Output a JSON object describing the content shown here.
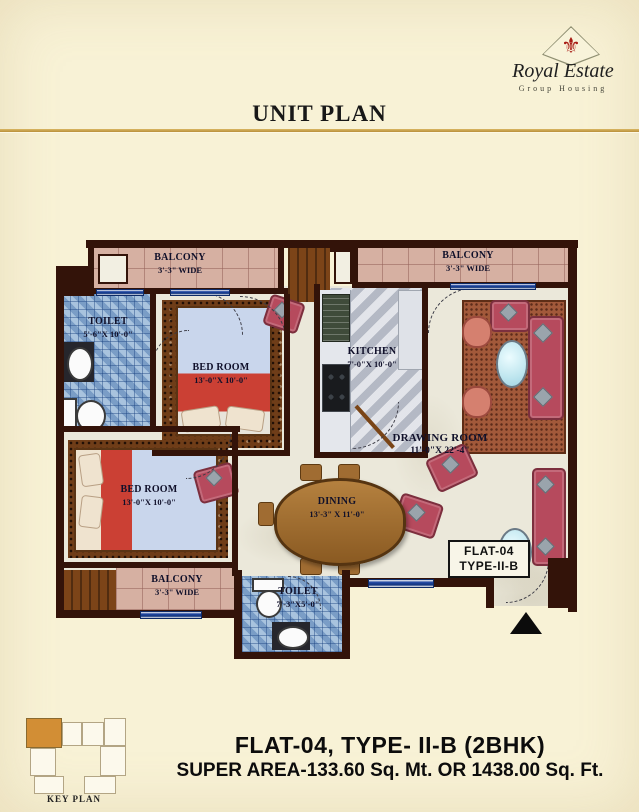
{
  "header": {
    "brand": {
      "name": "Royal Estate",
      "tagline": "Group Housing"
    },
    "title": "UNIT PLAN"
  },
  "plan": {
    "rooms": {
      "balcony_top_left": {
        "name": "BALCONY",
        "size": "3'-3\" WIDE"
      },
      "balcony_top_right": {
        "name": "BALCONY",
        "size": "3'-3\" WIDE"
      },
      "balcony_bottom": {
        "name": "BALCONY",
        "size": "3'-3\" WIDE"
      },
      "toilet_top": {
        "name": "TOILET",
        "size": "5'-6\"X 10'-0\""
      },
      "bedroom_top": {
        "name": "BED ROOM",
        "size": "13'-0\"X 10'-0\""
      },
      "bedroom_left": {
        "name": "BED ROOM",
        "size": "13'-0\"X 10'-0\""
      },
      "kitchen": {
        "name": "KITCHEN",
        "size": "7'-0\"X 10'-0\""
      },
      "drawing_room": {
        "name": "DRAWING ROOM",
        "size": "11'-0\"X 22'-4\""
      },
      "dining": {
        "name": "DINING",
        "size": "13'-3\" X 11'-0\""
      },
      "toilet_bottom": {
        "name": "TOILET",
        "size": "7'-3\"X5'-0\""
      }
    },
    "flat_tag": {
      "line1": "FLAT-04",
      "line2": "TYPE-II-B"
    }
  },
  "key_plan": {
    "label": "KEY PLAN"
  },
  "footer": {
    "flat_title": "FLAT-04, TYPE- II-B (2BHK)",
    "super_area": "SUPER AREA-133.60 Sq. Mt. OR 1438.00 Sq. Ft."
  },
  "icons": {
    "brand": "fleur-de-lis-icon",
    "entry_marker": "entry-arrow-icon"
  },
  "colors": {
    "page_background": "#f8f2d6",
    "accent_gold": "#c9a44e",
    "wall": "#331309",
    "brand_red": "#a81c15",
    "toilet_tile_blue": "#93b4d6",
    "balcony_tile_pink": "#d6b0a2"
  }
}
